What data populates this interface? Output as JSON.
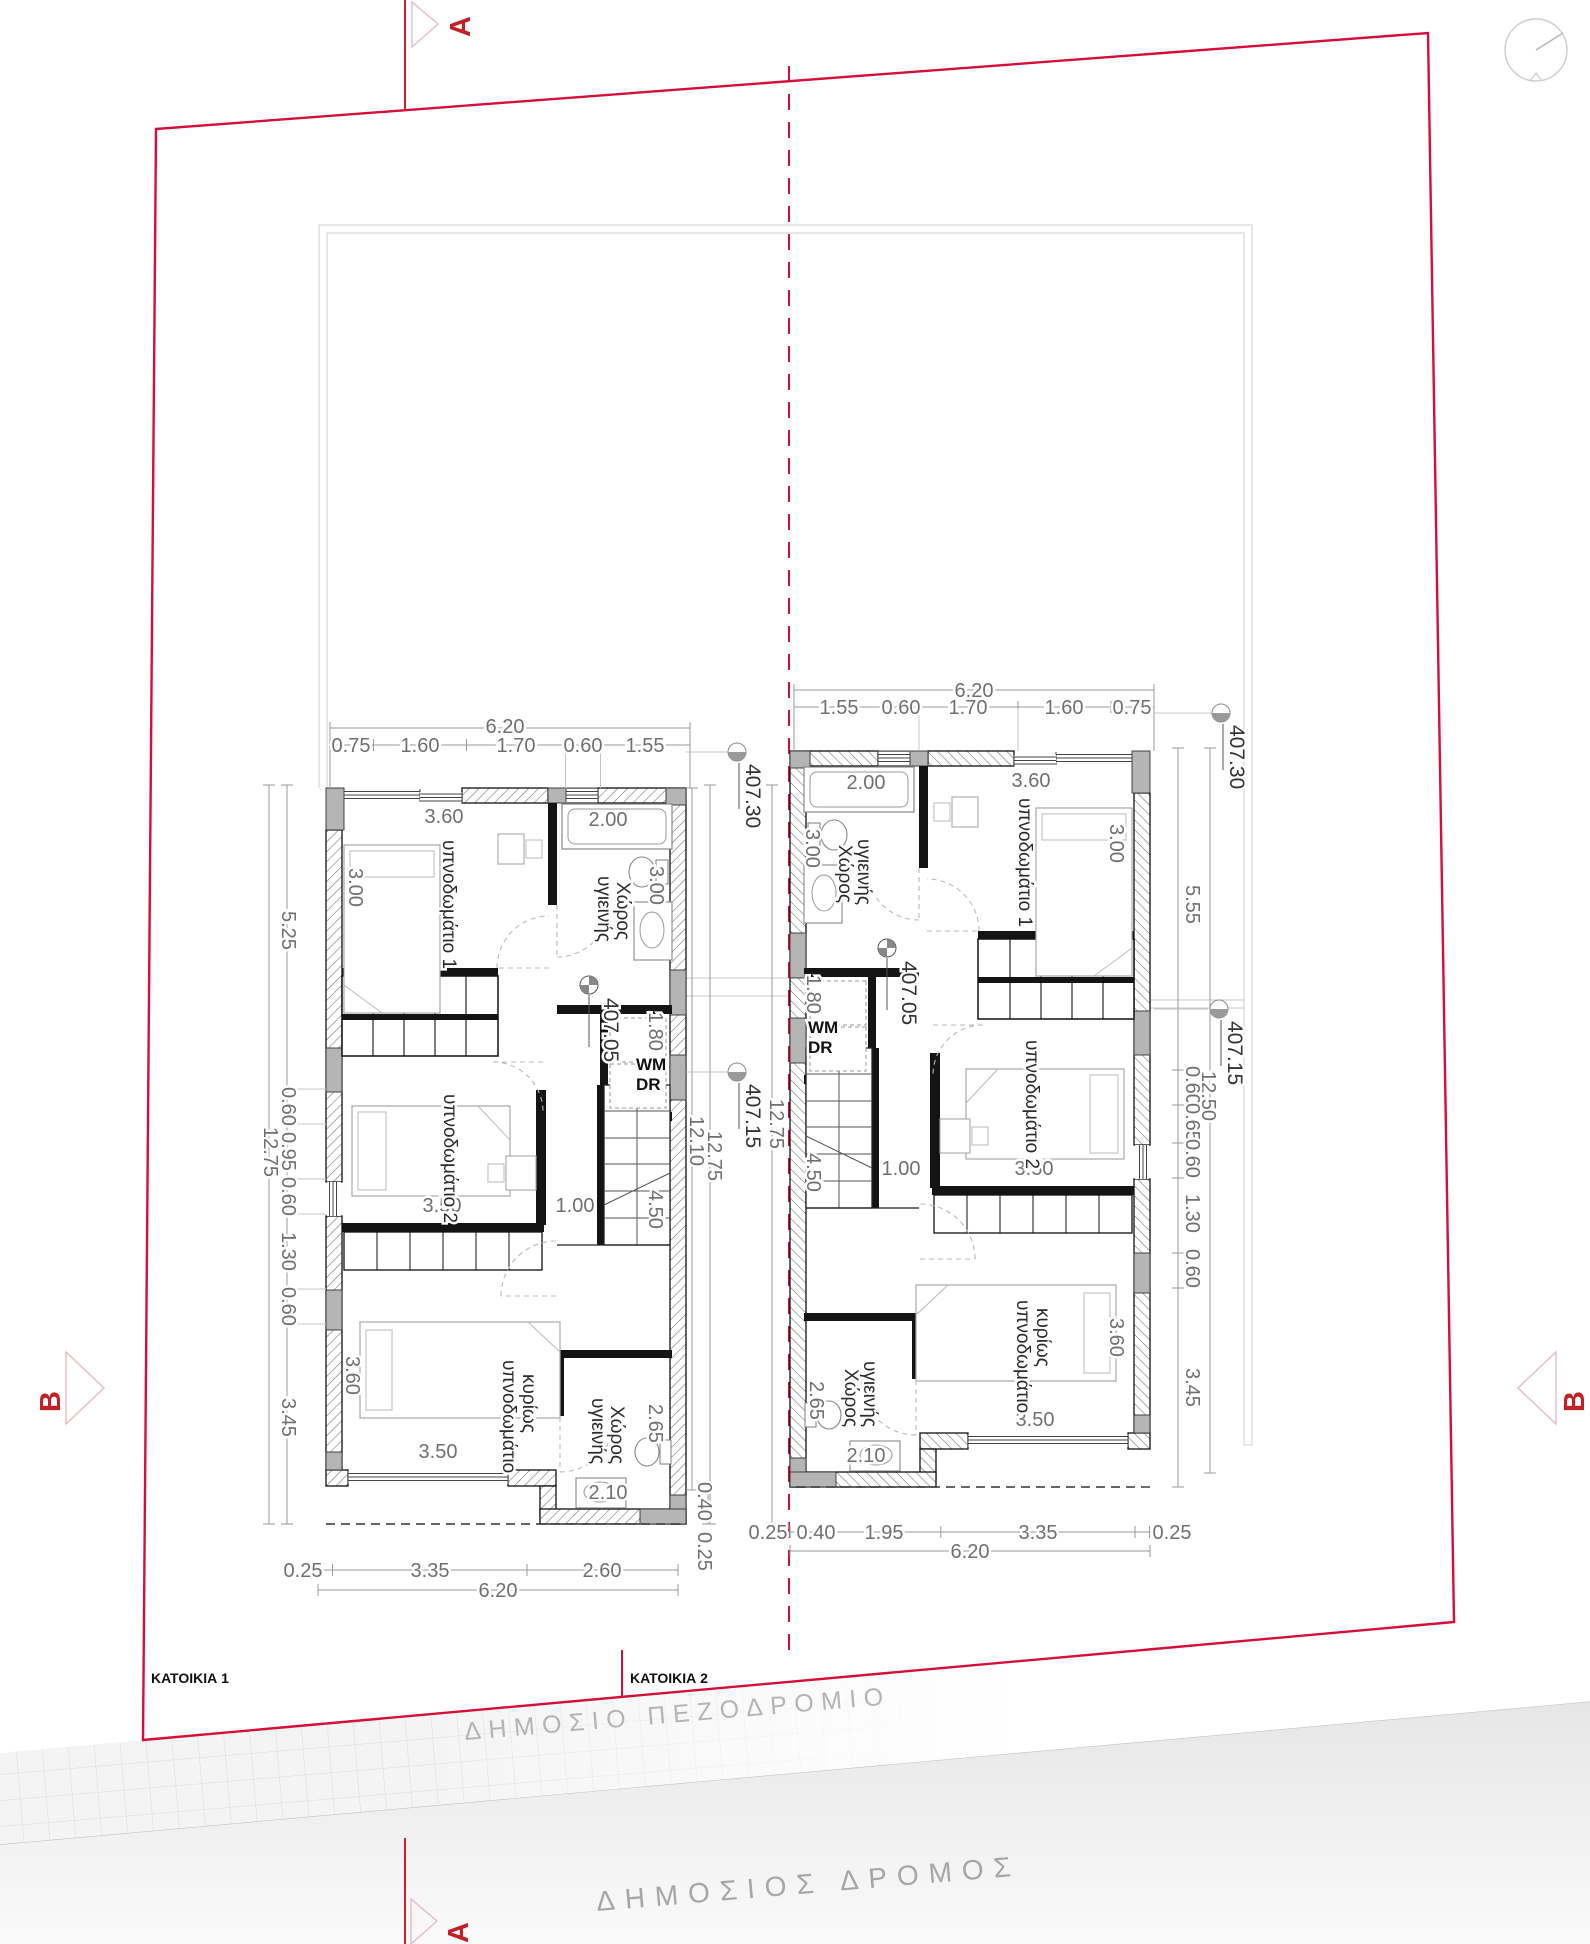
{
  "site": {
    "katoikia1": "ΚΑΤΟΙΚΙΑ 1",
    "katoikia2": "ΚΑΤΟΙΚΙΑ 2",
    "sidewalk": "ΔΗΜΟΣΙΟ ΠΕΖΟΔΡΟΜΙΟ",
    "road": "ΔΗΜΟΣΙΟΣ ΔΡΟΜΟΣ",
    "section_a": "A",
    "section_b": "B"
  },
  "levels": {
    "top": "407.30",
    "mid": "407.15",
    "floor": "407.05"
  },
  "rooms": {
    "bedroom1": "υπνοδωμάτιο 1",
    "bedroom2": "υπνοδωμάτιο 2",
    "master1": "κυρίως",
    "master2": "υπνοδωμάτιο",
    "bath1": "Χώρος",
    "bath2": "υγιεινής",
    "wm": "WM",
    "dr": "DR"
  },
  "house1": {
    "top_total": "6.20",
    "top_segs": [
      "0.75",
      "1.60",
      "1.70",
      "0.60",
      "1.55"
    ],
    "left_total": "12.75",
    "left_major": [
      "5.25",
      "3.45"
    ],
    "left_segs": [
      "0.60",
      "0.95",
      "0.60",
      "1.30",
      "0.60"
    ],
    "bottom_segs": [
      "0.25",
      "3.35",
      "2.60"
    ],
    "bottom_total": "6.20",
    "jog_segs": [
      "0.40",
      "0.25"
    ],
    "gap_dims": [
      "12.10",
      "12.75",
      "12.75"
    ],
    "d": {
      "bed1w": "3.60",
      "bed1d": "3.00",
      "bathw": "2.00",
      "bathd": "3.00",
      "wmd": "1.80",
      "bed2w": "3.50",
      "hall": "1.00",
      "stair": "4.50",
      "masterd": "3.60",
      "masterw": "3.50",
      "bath2d": "2.65",
      "bath2w": "2.10"
    }
  },
  "house2": {
    "top_total": "6.20",
    "top_segs": [
      "1.55",
      "0.60",
      "1.70",
      "1.60",
      "0.75"
    ],
    "right_total": "12.50",
    "right_major": [
      "5.55",
      "3.45"
    ],
    "right_segs": [
      "0.60",
      "0.65",
      "0.60",
      "1.30",
      "0.60"
    ],
    "bottom_segs": [
      "0.25",
      "0.40",
      "1.95",
      "3.35",
      "0.25"
    ],
    "bottom_total": "6.20",
    "d": {
      "bed1w": "3.60",
      "bed1d": "3.00",
      "bathw": "2.00",
      "bathd": "3.00",
      "wmd": "1.80",
      "bed2w": "3.50",
      "hall": "1.00",
      "stair": "4.50",
      "masterd": "3.60",
      "masterw": "3.50",
      "bath2d": "2.65",
      "bath2w": "2.10"
    }
  }
}
